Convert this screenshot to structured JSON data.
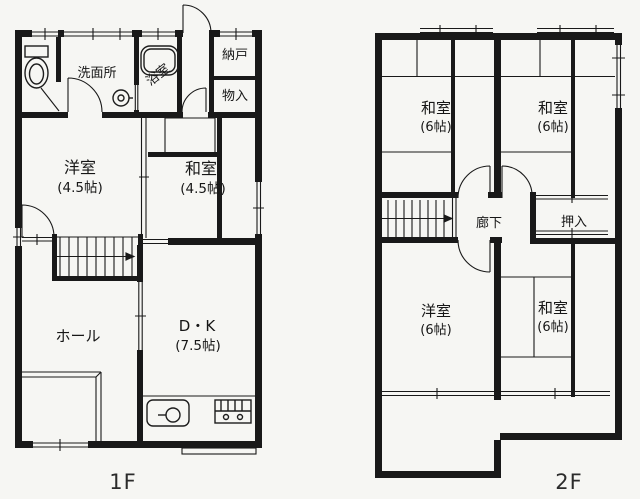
{
  "colors": {
    "ink": "#191919",
    "paper": "#f6f6f3"
  },
  "floor1": {
    "label": "1F",
    "rooms": {
      "washroom": "洗面所",
      "bathroom": "浴室",
      "storeroom": "納戸",
      "closet": "物入",
      "western_room": "洋室",
      "western_room_size": "(4.5帖)",
      "japanese_room": "和室",
      "japanese_room_size": "(4.5帖)",
      "hall": "ホール",
      "dining_kitchen": "D・K",
      "dining_kitchen_size": "(7.5帖)"
    }
  },
  "floor2": {
    "label": "2F",
    "rooms": {
      "japanese_room_nw": "和室",
      "japanese_room_nw_size": "(6帖)",
      "japanese_room_ne": "和室",
      "japanese_room_ne_size": "(6帖)",
      "corridor": "廊下",
      "oshiire": "押入",
      "western_room": "洋室",
      "western_room_size": "(6帖)",
      "japanese_room_s": "和室",
      "japanese_room_s_size": "(6帖)"
    }
  }
}
